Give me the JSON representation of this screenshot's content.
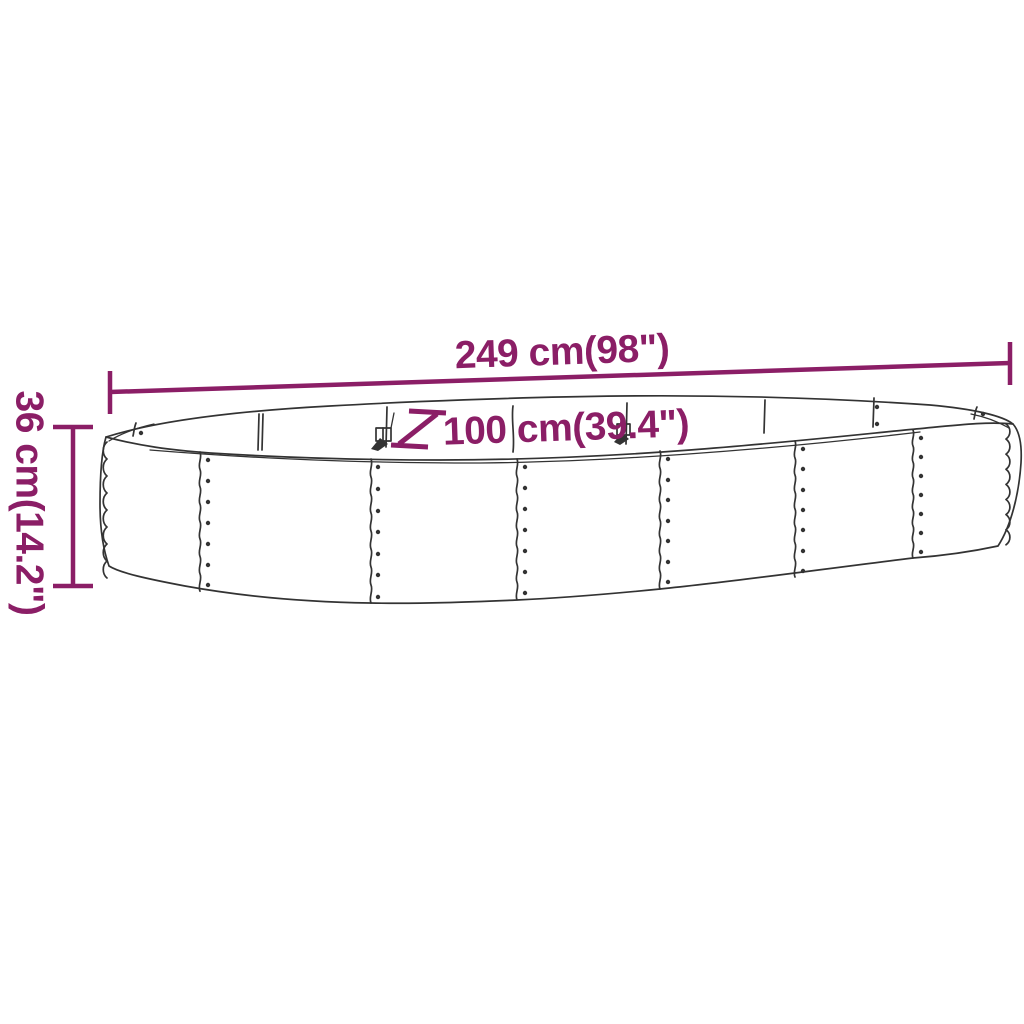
{
  "colors": {
    "accent": "#8B1E66",
    "line": "#333333",
    "background": "#FFFFFF"
  },
  "product_diagram": {
    "length_label": "249 cm(98\")",
    "width_label": "100 cm(39.4\")",
    "height_label": "36 cm(14.2\")"
  }
}
